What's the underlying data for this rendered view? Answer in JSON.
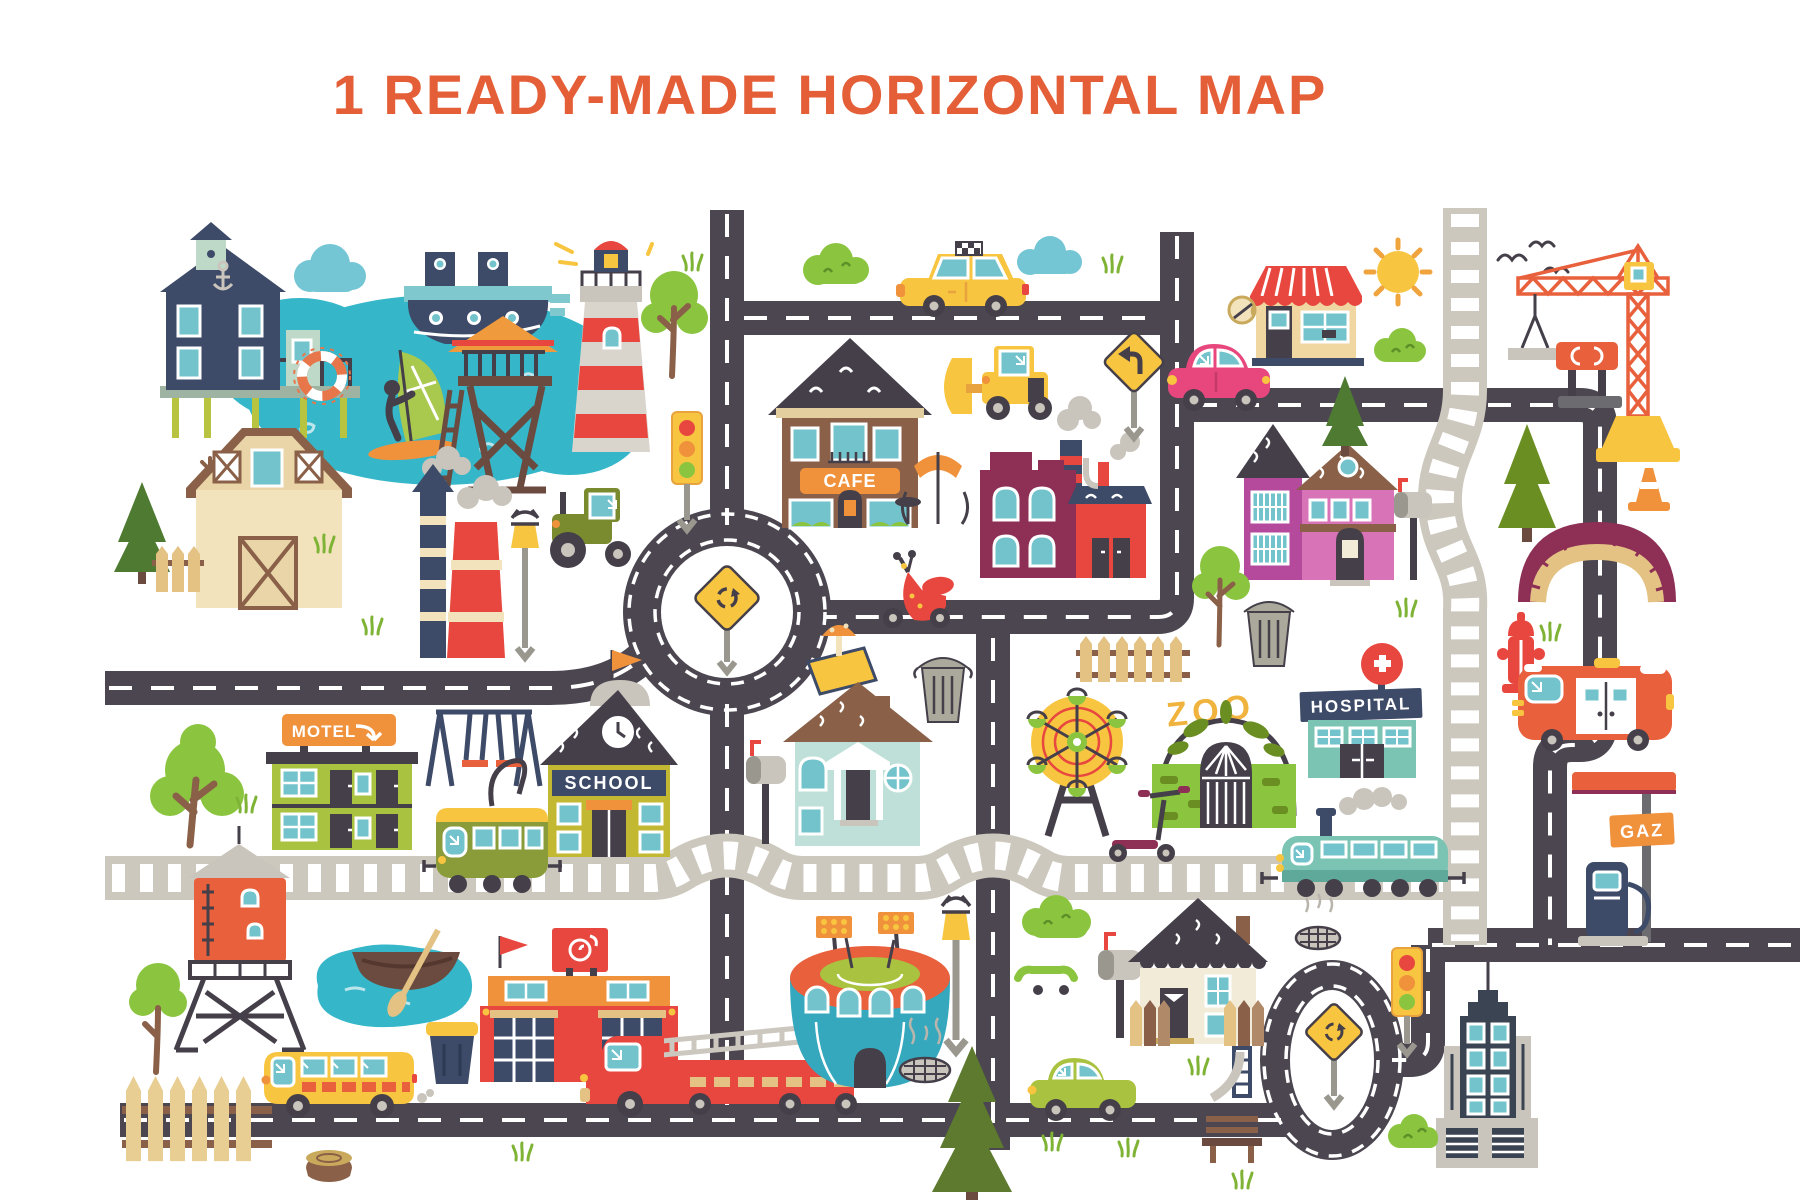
{
  "title": "1 READY-MADE HORIZONTAL MAP",
  "signs": {
    "cafe": "CAFE",
    "motel": "MOTEL",
    "school": "SCHOOL",
    "hospital": "HOSPITAL",
    "zoo": "ZOO",
    "gas_station": "GAZ"
  },
  "colors": {
    "background": "#FFFFFF",
    "title_text": "#E45F38",
    "road": "#4B4650",
    "road_marking": "#FFFFFF",
    "railroad": "#CDC8BD",
    "water": "#35B6C9",
    "foliage_green": "#8BC540",
    "sign_yellow": "#F7C53F",
    "accent_red": "#E8473F",
    "accent_orange": "#F0913C",
    "navy": "#3D4A68",
    "maroon": "#8E2F55"
  },
  "landmarks": [
    "stilt-house",
    "lake",
    "windsurfer",
    "lifebuoy",
    "ship",
    "cloud",
    "lighthouse",
    "watchtower",
    "barn",
    "pine-tree",
    "smokestacks",
    "tractor",
    "street-lamp",
    "traffic-light",
    "roundabout",
    "roundabout-sign",
    "cafe",
    "sidewalk-cafe-umbrella",
    "taxi",
    "bush",
    "bulldozer",
    "factory",
    "vespa-scooter",
    "sandbox",
    "trash-can",
    "picket-fence",
    "purple-house",
    "mailbox",
    "coffee-shop",
    "sun",
    "pink-car",
    "left-turn-sign",
    "railroad",
    "crane",
    "birds",
    "billboard",
    "traffic-cone",
    "arch-bridge",
    "fire-hydrant",
    "hospital",
    "zoo-gate",
    "ferris-wheel",
    "kick-scooter",
    "blue-house",
    "motel",
    "swing-set",
    "school",
    "tram",
    "train",
    "water-tower",
    "tree",
    "pond-with-rowboat",
    "school-bus",
    "recycle-bin",
    "fire-station",
    "fire-truck",
    "stadium",
    "manhole",
    "skateboard",
    "cream-house",
    "green-car",
    "bench",
    "slide",
    "spruce",
    "grass",
    "tree-stump",
    "ambulance",
    "gas-station",
    "gas-pump",
    "skyscraper"
  ]
}
